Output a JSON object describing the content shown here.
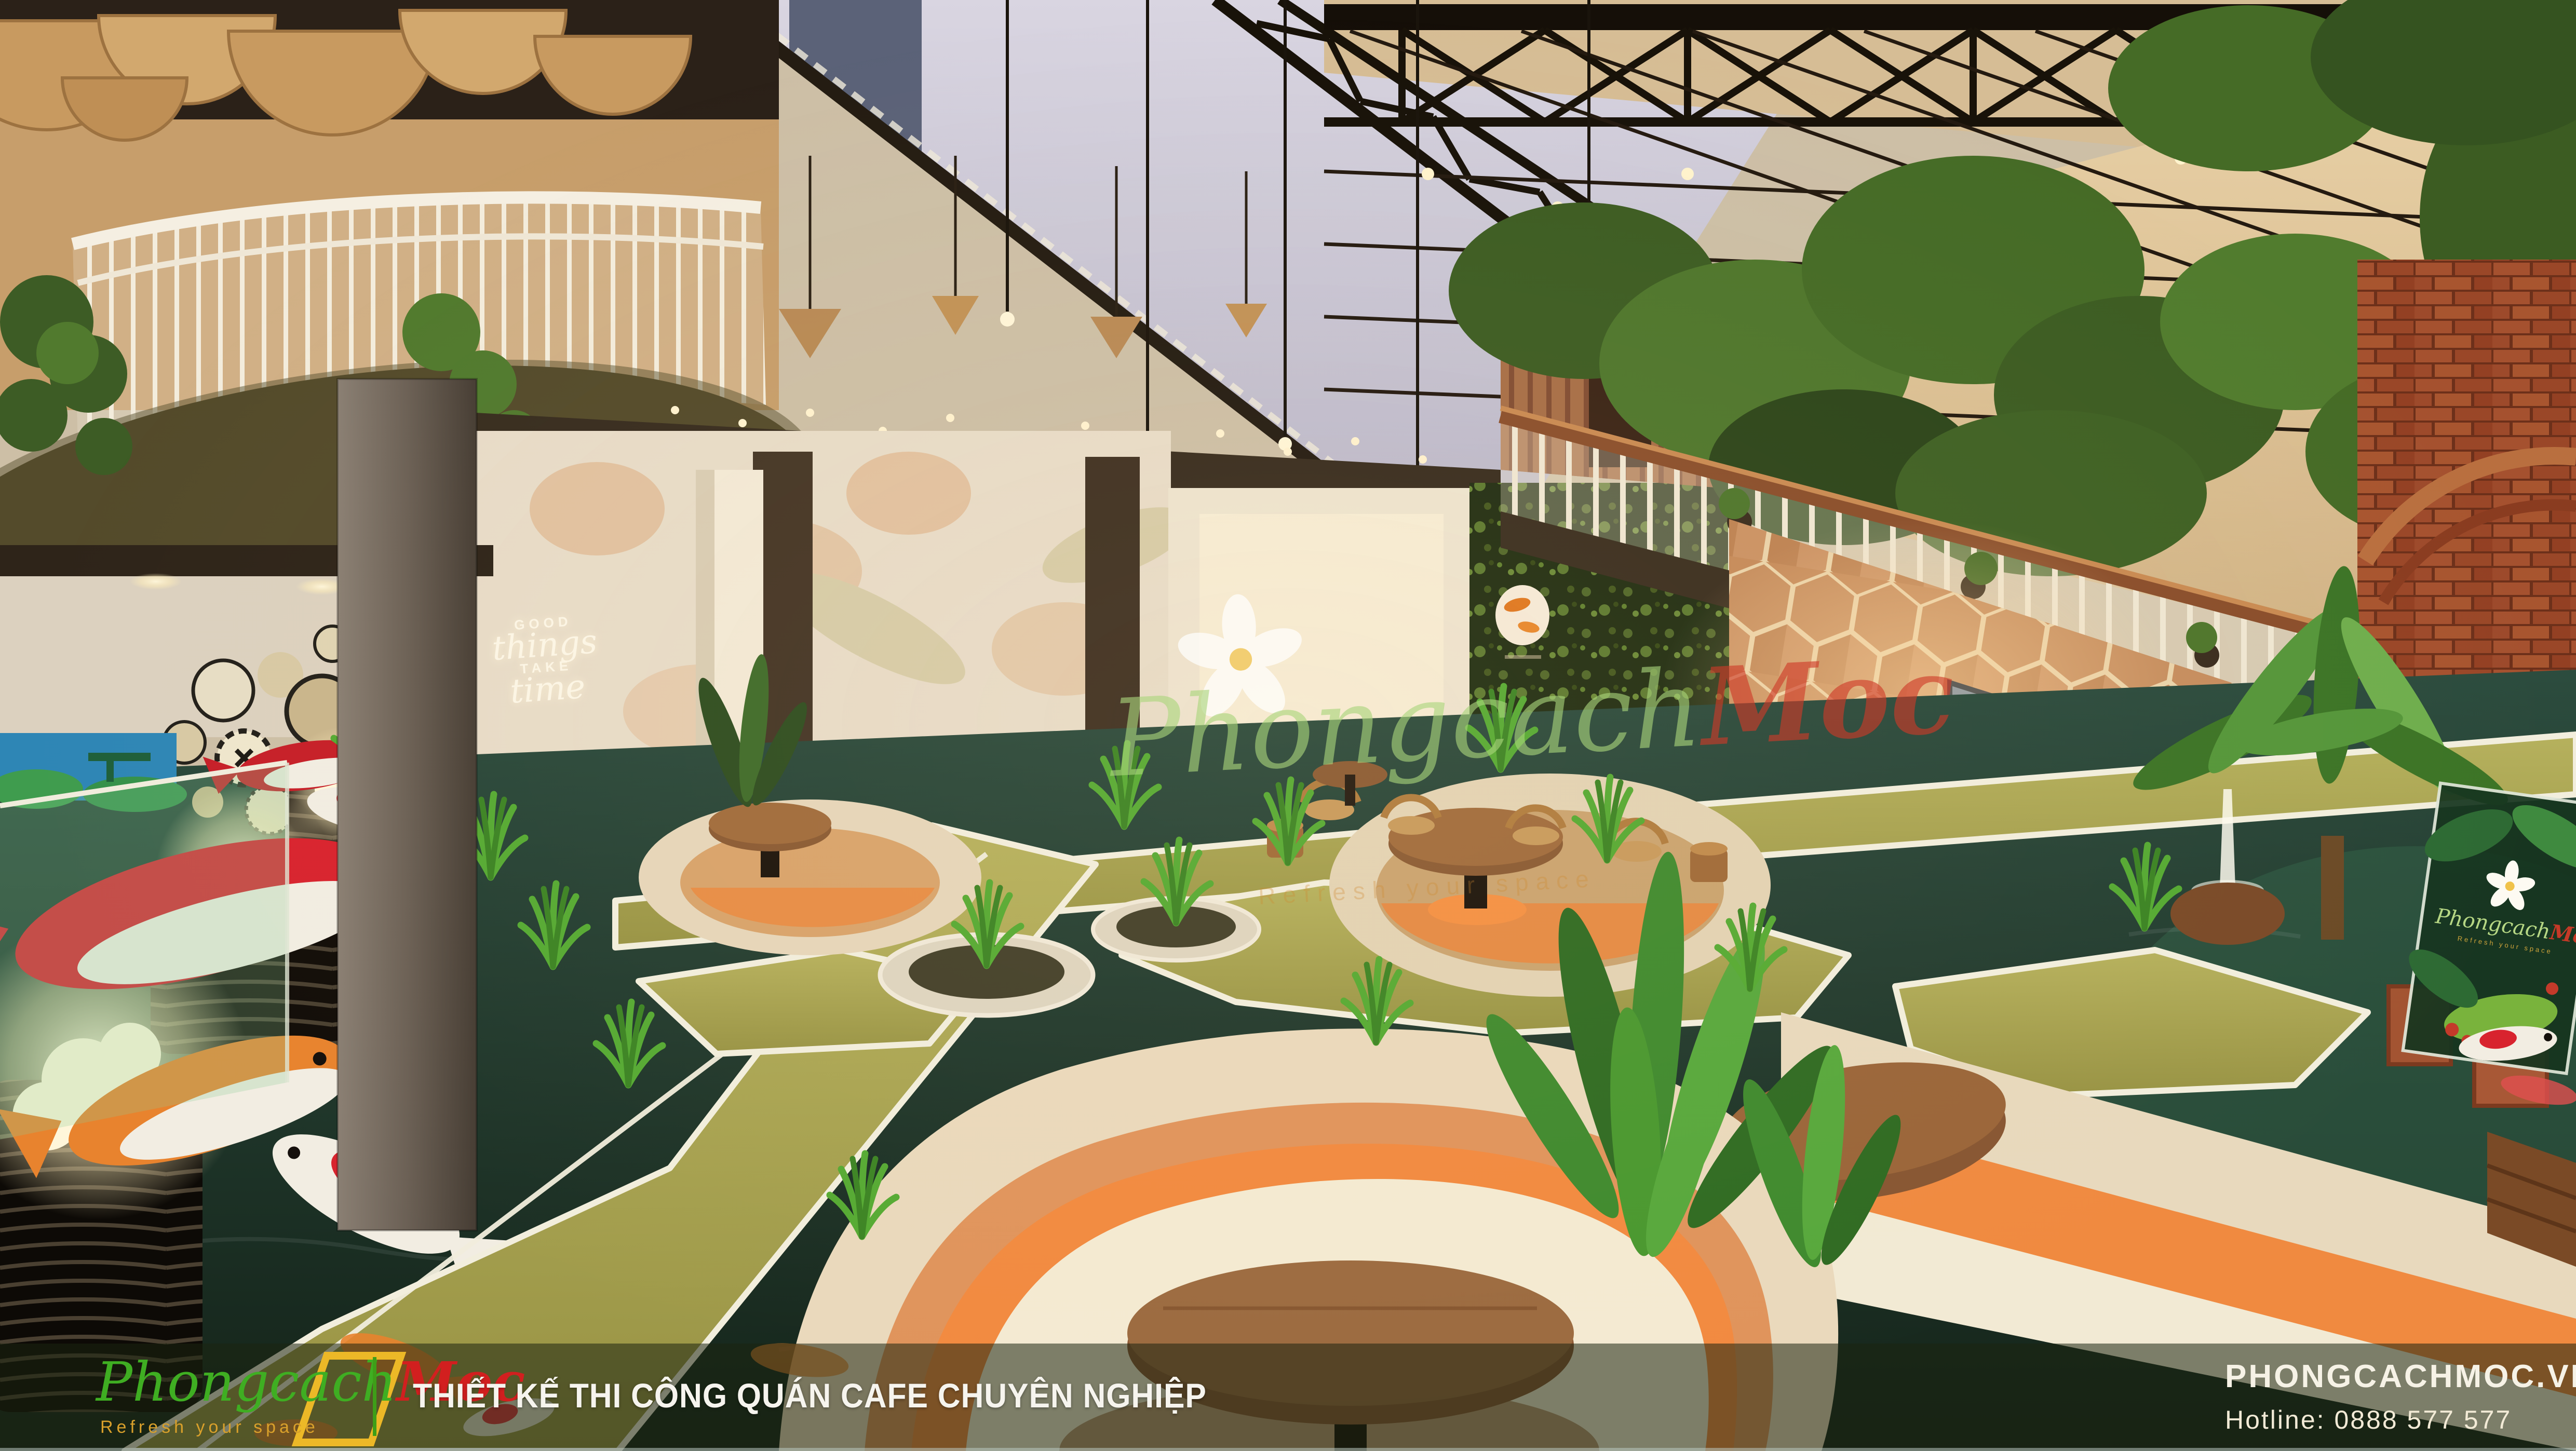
{
  "brand": {
    "logo_main": "Phongcach",
    "logo_accent": "Moc",
    "tagline": "Refresh your space"
  },
  "footer": {
    "headline": "THIẾT KẾ THI CÔNG QUÁN CAFE CHUYÊN NGHIỆP",
    "website": "PHONGCACHMOC.VN",
    "hotline_label": "Hotline:",
    "hotline_number": "0888 577 577"
  },
  "wall_sign": {
    "word1": "GOOD",
    "word2": "things",
    "word3": "TAKE",
    "word4": "time"
  },
  "colors": {
    "brand_green": "#3fae22",
    "brand_red": "#d21f1f",
    "brand_yellow": "#ecb827",
    "footer_divider": "#3e9e18",
    "cushion_orange": "#f08a40",
    "grass_olive": "#a9a553",
    "pond_teal": "#24443a",
    "moss_green": "#27351a",
    "hex_wood": "#c58a5a",
    "brick_red": "#a5512f"
  }
}
